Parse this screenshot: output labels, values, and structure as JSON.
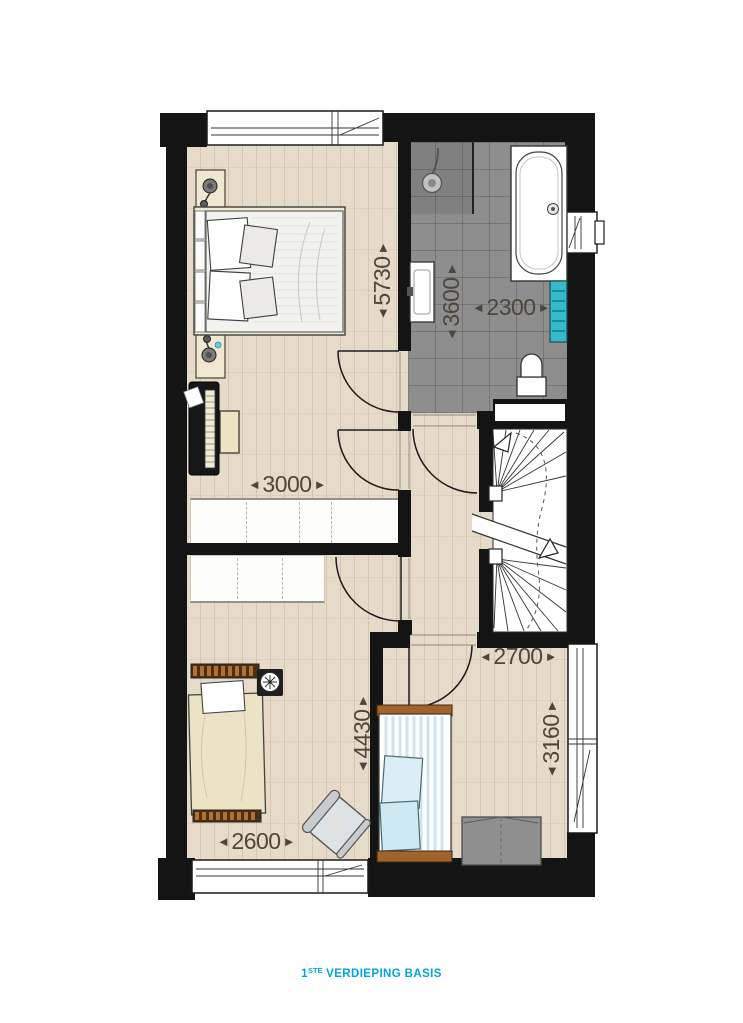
{
  "caption": {
    "number": "1",
    "ordinal": "STE",
    "text": "VERDIEPING BASIS",
    "color": "#00a5dc"
  },
  "arrows": {
    "left": "◄",
    "right": "►"
  },
  "dimensions": [
    {
      "id": "master-bedroom-depth",
      "value": "5730",
      "orientation": "vertical"
    },
    {
      "id": "bathroom-depth",
      "value": "3600",
      "orientation": "vertical"
    },
    {
      "id": "bathroom-width",
      "value": "2300",
      "orientation": "horizontal"
    },
    {
      "id": "master-bedroom-width",
      "value": "3000",
      "orientation": "horizontal"
    },
    {
      "id": "bedroom3-width",
      "value": "2700",
      "orientation": "horizontal"
    },
    {
      "id": "bedroom2-depth",
      "value": "4430",
      "orientation": "vertical"
    },
    {
      "id": "bedroom3-depth",
      "value": "3160",
      "orientation": "vertical"
    },
    {
      "id": "bedroom2-width",
      "value": "2600",
      "orientation": "horizontal"
    }
  ],
  "colors": {
    "wall": "#141414",
    "wood_floor": "#e6dac8",
    "tile_floor": "#8e8e8e",
    "towel_radiator": "#35bcca",
    "dimension_text": "#4c463c",
    "caption_text": "#00a5dc"
  },
  "objects": [
    "double-bed",
    "nightstand-lamp",
    "upright-piano",
    "piano-bench",
    "built-in-wardrobe",
    "shower",
    "washbasin",
    "bathtub",
    "towel-radiator",
    "toilet",
    "winder-staircase",
    "single-bed",
    "wall-clock",
    "armchair",
    "storage-box",
    "window",
    "door-swing"
  ]
}
